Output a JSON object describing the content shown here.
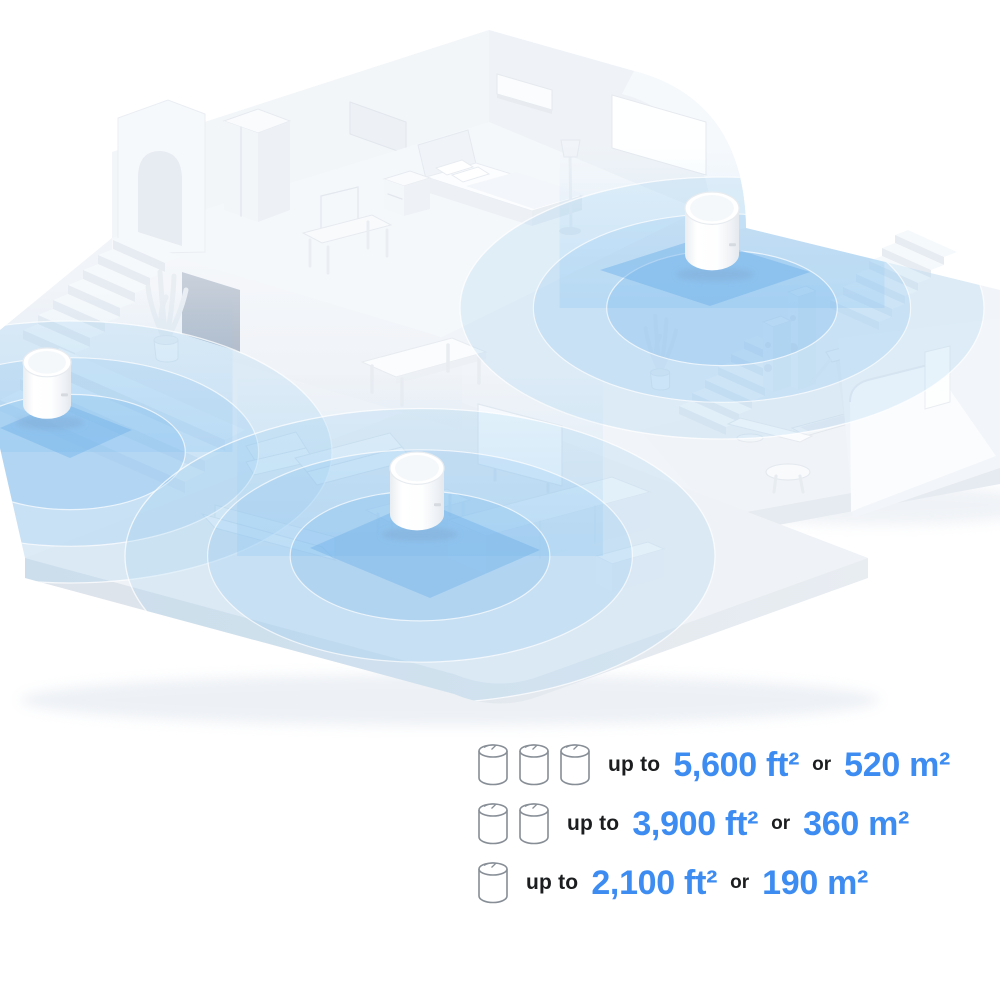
{
  "illustration": {
    "type": "isometric-house-wifi-coverage",
    "deco_unit_count": 3,
    "zone_color": "#8FC3ED",
    "accent_blue": "#3D8CF2"
  },
  "coverage": {
    "rows": [
      {
        "units": 3,
        "prefix": "up to",
        "imperial": "5,600 ft²",
        "conjunction": "or",
        "metric": "520 m²"
      },
      {
        "units": 2,
        "prefix": "up to",
        "imperial": "3,900 ft²",
        "conjunction": "or",
        "metric": "360 m²"
      },
      {
        "units": 1,
        "prefix": "up to",
        "imperial": "2,100 ft²",
        "conjunction": "or",
        "metric": "190 m²"
      }
    ]
  }
}
